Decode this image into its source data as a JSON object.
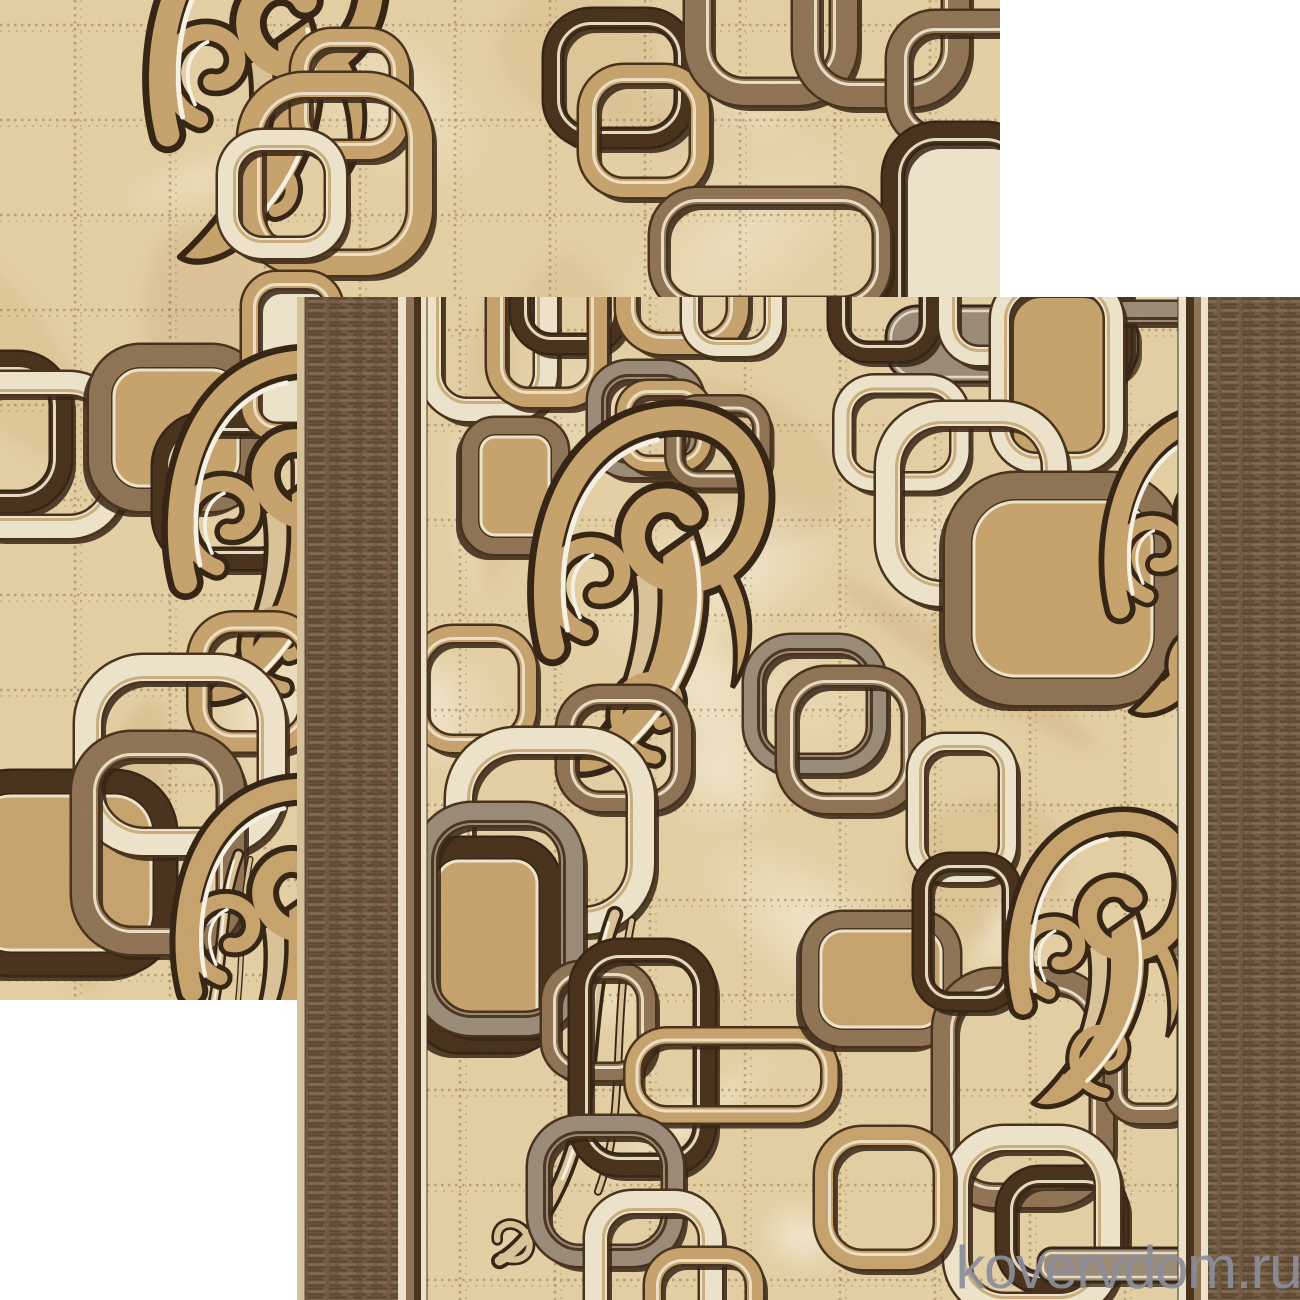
{
  "watermark": {
    "text": "kovervdom.ru",
    "color": "#8b8e9a"
  },
  "palette": {
    "white": "#ffffff",
    "field": "#e7d3a7",
    "fieldl": "#f6ecd1",
    "fieldd": "#cfae7d",
    "stitch": "#8d7146",
    "cream": "#f1e8d0",
    "creamhi": "#fbf7ea",
    "tanline": "#c9ad79",
    "tan": "#c8a46d",
    "tanl": "#dcc59b",
    "brown": "#8d7254",
    "gray": "#9a8b7a",
    "espresso": "#432d18",
    "dk": "#2f1f10",
    "weave": "#6d5742",
    "weaved": "#57422d",
    "weavel": "#7f6a53",
    "selvage": "#d9c59d",
    "wm": "#8b8e9a"
  },
  "scene": {
    "canvas": {
      "w": 1300,
      "h": 1300
    },
    "back_tile": {
      "x": 0,
      "y": 0,
      "w": 1000,
      "h": 1000
    },
    "front_tile": {
      "x": 297,
      "y": 297,
      "w": 1003,
      "h": 1003
    },
    "front_borders": {
      "selvage": [
        297,
        306
      ],
      "left_weave": [
        306,
        398
      ],
      "left_stripes": [
        [
          398,
          406,
          "cream"
        ],
        [
          406,
          414,
          "brown"
        ],
        [
          414,
          421,
          "espresso"
        ],
        [
          421,
          427,
          "cream"
        ]
      ],
      "field": [
        427,
        1178
      ],
      "right_stripes": [
        [
          1178,
          1186,
          "cream"
        ],
        [
          1186,
          1194,
          "espresso"
        ],
        [
          1194,
          1201,
          "brown"
        ],
        [
          1201,
          1208,
          "cream"
        ]
      ],
      "right_weave": [
        1208,
        1300
      ]
    },
    "grid": {
      "step": 95,
      "back": {
        "vx": 75,
        "hy": 25
      },
      "front": {
        "vx": 460,
        "hy": 330
      }
    },
    "back_motifs": [
      {
        "t": "swirl",
        "x": 120,
        "y": -128,
        "k": 1.25
      },
      {
        "t": "ring",
        "c": "tan",
        "x": 300,
        "y": 38,
        "w": 100,
        "h": 112,
        "s": 18
      },
      {
        "t": "ring",
        "c": "tan",
        "x": 250,
        "y": 85,
        "w": 170,
        "h": 178,
        "s": 24
      },
      {
        "t": "ring",
        "c": "cream",
        "x": 228,
        "y": 140,
        "w": 108,
        "h": 108,
        "s": 20
      },
      {
        "t": "ring",
        "c": "espresso",
        "x": 553,
        "y": 18,
        "w": 132,
        "h": 120,
        "s": 18
      },
      {
        "t": "ring",
        "c": "tan",
        "x": 588,
        "y": 74,
        "w": 112,
        "h": 114,
        "s": 18
      },
      {
        "t": "ring",
        "c": "brown",
        "x": 698,
        "y": -80,
        "w": 146,
        "h": 172,
        "s": 26
      },
      {
        "t": "ring",
        "c": "brown",
        "x": 806,
        "y": -50,
        "w": 150,
        "h": 144,
        "s": 26
      },
      {
        "t": "ring",
        "c": "brown",
        "x": 898,
        "y": 22,
        "w": 152,
        "h": 116,
        "s": 22
      },
      {
        "t": "capsule",
        "c": "espresso",
        "f": "cream",
        "x": 893,
        "y": 133,
        "w": 136,
        "h": 292,
        "s": 20
      },
      {
        "t": "ring",
        "c": "brown",
        "x": 658,
        "y": 196,
        "w": 224,
        "h": 110,
        "s": 16,
        "rx": 40
      },
      {
        "t": "ring",
        "c": "espresso",
        "x": -75,
        "y": 362,
        "w": 136,
        "h": 140,
        "s": 20
      },
      {
        "t": "ring",
        "c": "cream",
        "x": -45,
        "y": 383,
        "w": 160,
        "h": 144,
        "s": 22
      },
      {
        "t": "square",
        "c": "brown",
        "f": "tan",
        "x": 100,
        "y": 356,
        "w": 152,
        "h": 144,
        "s": 22
      },
      {
        "t": "ring",
        "c": "espresso",
        "x": 163,
        "y": 423,
        "w": 140,
        "h": 136,
        "s": 20
      },
      {
        "t": "capsule",
        "c": "tan",
        "f": "cream",
        "x": 250,
        "y": 280,
        "w": 84,
        "h": 152,
        "s": 16
      },
      {
        "t": "swirl",
        "x": 140,
        "y": 330,
        "k": 1.2
      },
      {
        "t": "ring",
        "c": "tan",
        "x": 198,
        "y": 622,
        "w": 112,
        "h": 120,
        "s": 19
      },
      {
        "t": "square",
        "c": "espresso",
        "f": "tan",
        "x": -40,
        "y": 782,
        "w": 205,
        "h": 182,
        "s": 22
      },
      {
        "t": "ring",
        "c": "cream",
        "x": 88,
        "y": 668,
        "w": 184,
        "h": 174,
        "s": 26
      },
      {
        "t": "ring",
        "c": "brown",
        "x": 85,
        "y": 745,
        "w": 146,
        "h": 196,
        "s": 26
      },
      {
        "t": "tail",
        "x": 165,
        "y": 850,
        "k": 0.75
      },
      {
        "t": "swirl",
        "x": 150,
        "y": 760,
        "k": 1.1
      }
    ],
    "front_motifs": [
      {
        "t": "ring",
        "c": "cream",
        "x": 430,
        "y": 258,
        "w": 116,
        "h": 152,
        "s": 22
      },
      {
        "t": "ring",
        "c": "espresso",
        "x": 520,
        "y": 212,
        "w": 98,
        "h": 132,
        "s": 18
      },
      {
        "t": "ring",
        "c": "tan",
        "x": 496,
        "y": 246,
        "w": 102,
        "h": 152,
        "s": 18
      },
      {
        "t": "ring",
        "c": "tan",
        "x": 626,
        "y": 222,
        "w": 112,
        "h": 122,
        "s": 20
      },
      {
        "t": "ring",
        "c": "cream",
        "x": 690,
        "y": 232,
        "w": 84,
        "h": 116,
        "s": 16
      },
      {
        "t": "bar",
        "c": "gray",
        "x": 886,
        "y": 306,
        "w": 252,
        "h": 76
      },
      {
        "t": "ring",
        "c": "espresso",
        "x": 838,
        "y": 218,
        "w": 92,
        "h": 134,
        "s": 18
      },
      {
        "t": "ring",
        "c": "cream",
        "x": 948,
        "y": 226,
        "w": 96,
        "h": 130,
        "s": 18
      },
      {
        "t": "ring",
        "c": "espresso",
        "x": 1026,
        "y": 232,
        "w": 96,
        "h": 150,
        "s": 18
      },
      {
        "t": "ring",
        "c": "gray",
        "x": 597,
        "y": 370,
        "w": 98,
        "h": 98,
        "s": 18
      },
      {
        "t": "ring",
        "c": "tan",
        "x": 624,
        "y": 388,
        "w": 80,
        "h": 76,
        "s": 14
      },
      {
        "t": "ring",
        "c": "brown",
        "x": 674,
        "y": 404,
        "w": 88,
        "h": 76,
        "s": 15
      },
      {
        "t": "square",
        "c": "brown",
        "f": "tan",
        "x": 470,
        "y": 426,
        "w": 90,
        "h": 120,
        "s": 16
      },
      {
        "t": "ring",
        "c": "tan",
        "x": 418,
        "y": 634,
        "w": 110,
        "h": 110,
        "s": 16
      },
      {
        "t": "swirl",
        "x": 505,
        "y": 385,
        "k": 1.25
      },
      {
        "t": "ring",
        "c": "cream",
        "x": 843,
        "y": 384,
        "w": 117,
        "h": 98,
        "s": 17
      },
      {
        "t": "ring",
        "c": "gray",
        "x": 1062,
        "y": 312,
        "w": 200,
        "h": 272,
        "s": 20
      },
      {
        "t": "capsule",
        "c": "cream",
        "f": "tan",
        "x": 1000,
        "y": 283,
        "w": 114,
        "h": 180,
        "s": 18
      },
      {
        "t": "ring",
        "c": "cream",
        "x": 888,
        "y": 414,
        "w": 167,
        "h": 180,
        "s": 24
      },
      {
        "t": "square",
        "c": "brown",
        "f": "tan",
        "x": 958,
        "y": 486,
        "w": 210,
        "h": 206,
        "s": 26
      },
      {
        "t": "swirl",
        "x": 1080,
        "y": 388,
        "k": 1.05
      },
      {
        "t": "ring",
        "c": "gray",
        "x": 753,
        "y": 644,
        "w": 124,
        "h": 120,
        "s": 18
      },
      {
        "t": "ring",
        "c": "brown",
        "x": 786,
        "y": 676,
        "w": 126,
        "h": 128,
        "s": 18
      },
      {
        "t": "ring",
        "c": "brown",
        "x": 566,
        "y": 695,
        "w": 116,
        "h": 107,
        "s": 18
      },
      {
        "t": "ring",
        "c": "cream",
        "x": 459,
        "y": 741,
        "w": 182,
        "h": 180,
        "s": 26
      },
      {
        "t": "square",
        "c": "espresso",
        "f": "tan",
        "x": 424,
        "y": 848,
        "w": 126,
        "h": 194,
        "s": 20
      },
      {
        "t": "ring",
        "c": "gray",
        "x": 425,
        "y": 814,
        "w": 147,
        "h": 210,
        "s": 22
      },
      {
        "t": "tail",
        "x": 512,
        "y": 908,
        "k": 1.05
      },
      {
        "t": "ring",
        "c": "brown",
        "x": 550,
        "y": 970,
        "w": 97,
        "h": 102,
        "s": 16
      },
      {
        "t": "ring",
        "c": "espresso",
        "x": 580,
        "y": 950,
        "w": 125,
        "h": 215,
        "s": 20
      },
      {
        "t": "ring",
        "c": "tan",
        "x": 633,
        "y": 1036,
        "w": 197,
        "h": 79,
        "s": 15,
        "rx": 34
      },
      {
        "t": "ring",
        "c": "gray",
        "x": 538,
        "y": 1126,
        "w": 135,
        "h": 130,
        "s": 20
      },
      {
        "t": "ring",
        "c": "cream",
        "x": 596,
        "y": 1202,
        "w": 115,
        "h": 150,
        "s": 22
      },
      {
        "t": "ring",
        "c": "tan",
        "x": 653,
        "y": 1256,
        "w": 102,
        "h": 92,
        "s": 16
      },
      {
        "t": "square",
        "c": "brown",
        "f": "tan",
        "x": 810,
        "y": 920,
        "w": 142,
        "h": 118,
        "s": 16
      },
      {
        "t": "ring",
        "c": "brown",
        "x": 944,
        "y": 980,
        "w": 158,
        "h": 216,
        "s": 22
      },
      {
        "t": "ring",
        "c": "espresso",
        "x": 1006,
        "y": 1176,
        "w": 112,
        "h": 106,
        "s": 18
      },
      {
        "t": "ring",
        "c": "cream",
        "x": 956,
        "y": 1138,
        "w": 152,
        "h": 168,
        "s": 24
      },
      {
        "t": "ring",
        "c": "tan",
        "x": 824,
        "y": 1136,
        "w": 120,
        "h": 124,
        "s": 18
      },
      {
        "t": "ring",
        "c": "cream",
        "x": 916,
        "y": 742,
        "w": 92,
        "h": 132,
        "s": 16
      },
      {
        "t": "ring",
        "c": "espresso",
        "x": 922,
        "y": 862,
        "w": 90,
        "h": 140,
        "s": 16
      },
      {
        "t": "ring",
        "c": "brown",
        "x": 1114,
        "y": 948,
        "w": 74,
        "h": 166,
        "s": 18
      },
      {
        "t": "swirl",
        "x": 985,
        "y": 795,
        "k": 1.0
      },
      {
        "t": "bar",
        "c": "gray",
        "x": 1038,
        "y": 1248,
        "w": 156,
        "h": 34,
        "rx": 14
      }
    ]
  }
}
